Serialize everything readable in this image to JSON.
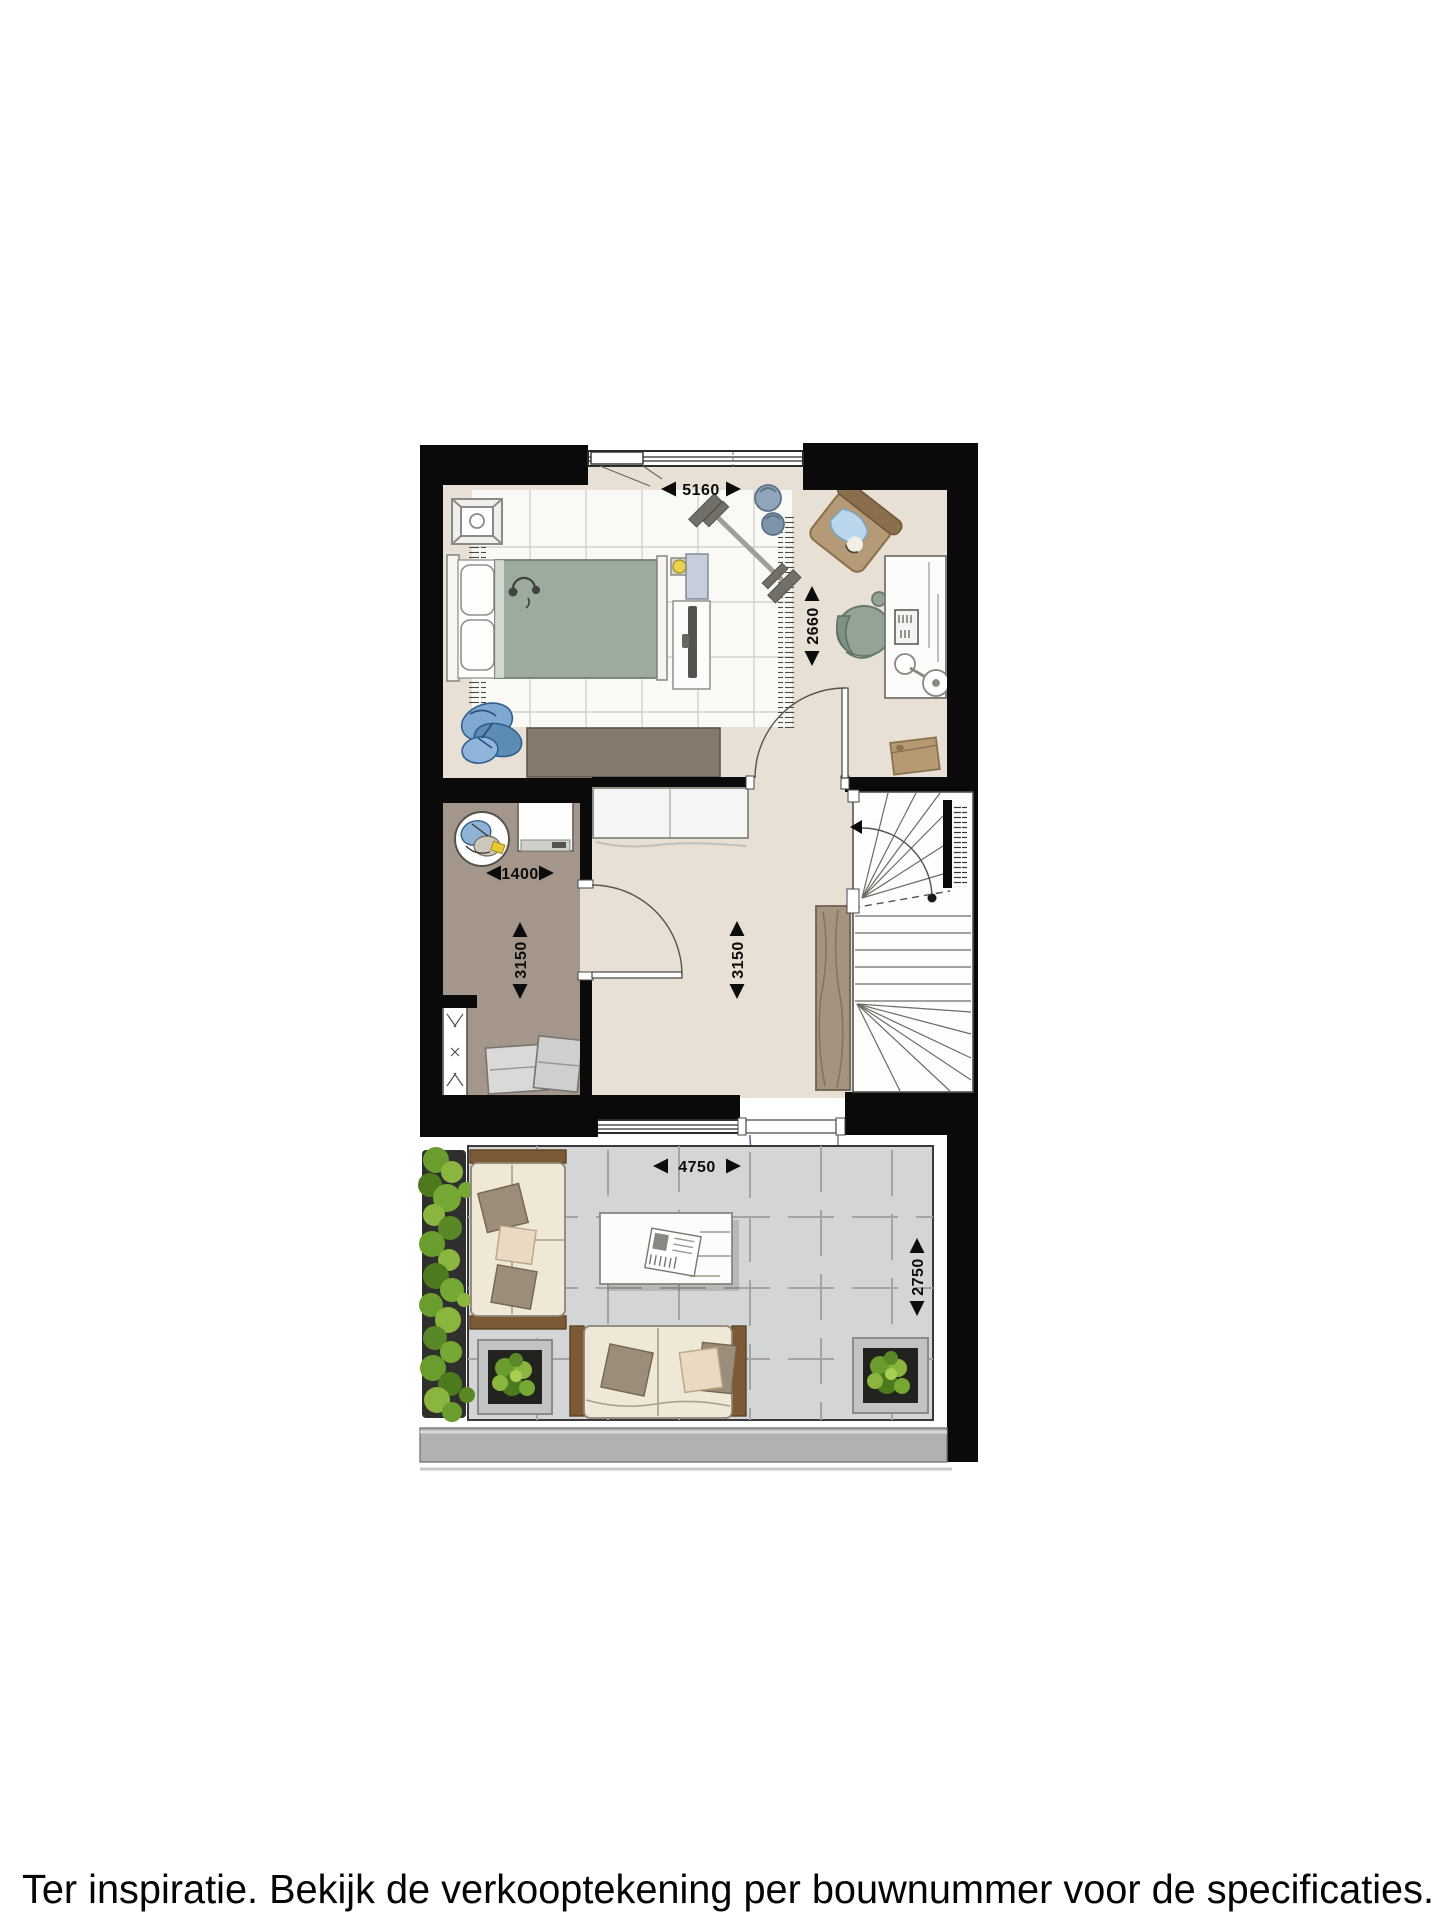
{
  "floorplan": {
    "caption": "Ter inspiratie. Bekijk de verkooptekening per bouwnummer voor de specificaties.",
    "dimensions": {
      "bedroom_width": "5160",
      "bedroom_depth": "2660",
      "storage_width": "1400",
      "storage_depth": "3150",
      "hall_depth": "3150",
      "terrace_width": "4750",
      "terrace_depth": "2750"
    },
    "colors": {
      "wall": "#0a0a0a",
      "interior_floor": "#e8e0d4",
      "storage_floor": "#a4968a",
      "terrace_floor": "#d4d5d7",
      "rug": "#fafaf8",
      "bed_duvet": "#9dab9c",
      "sofa_fabric": "#f0e8d6",
      "wood": "#7d5a36",
      "plant": "#76a834",
      "dimension_text": "#0c0c0c"
    }
  }
}
